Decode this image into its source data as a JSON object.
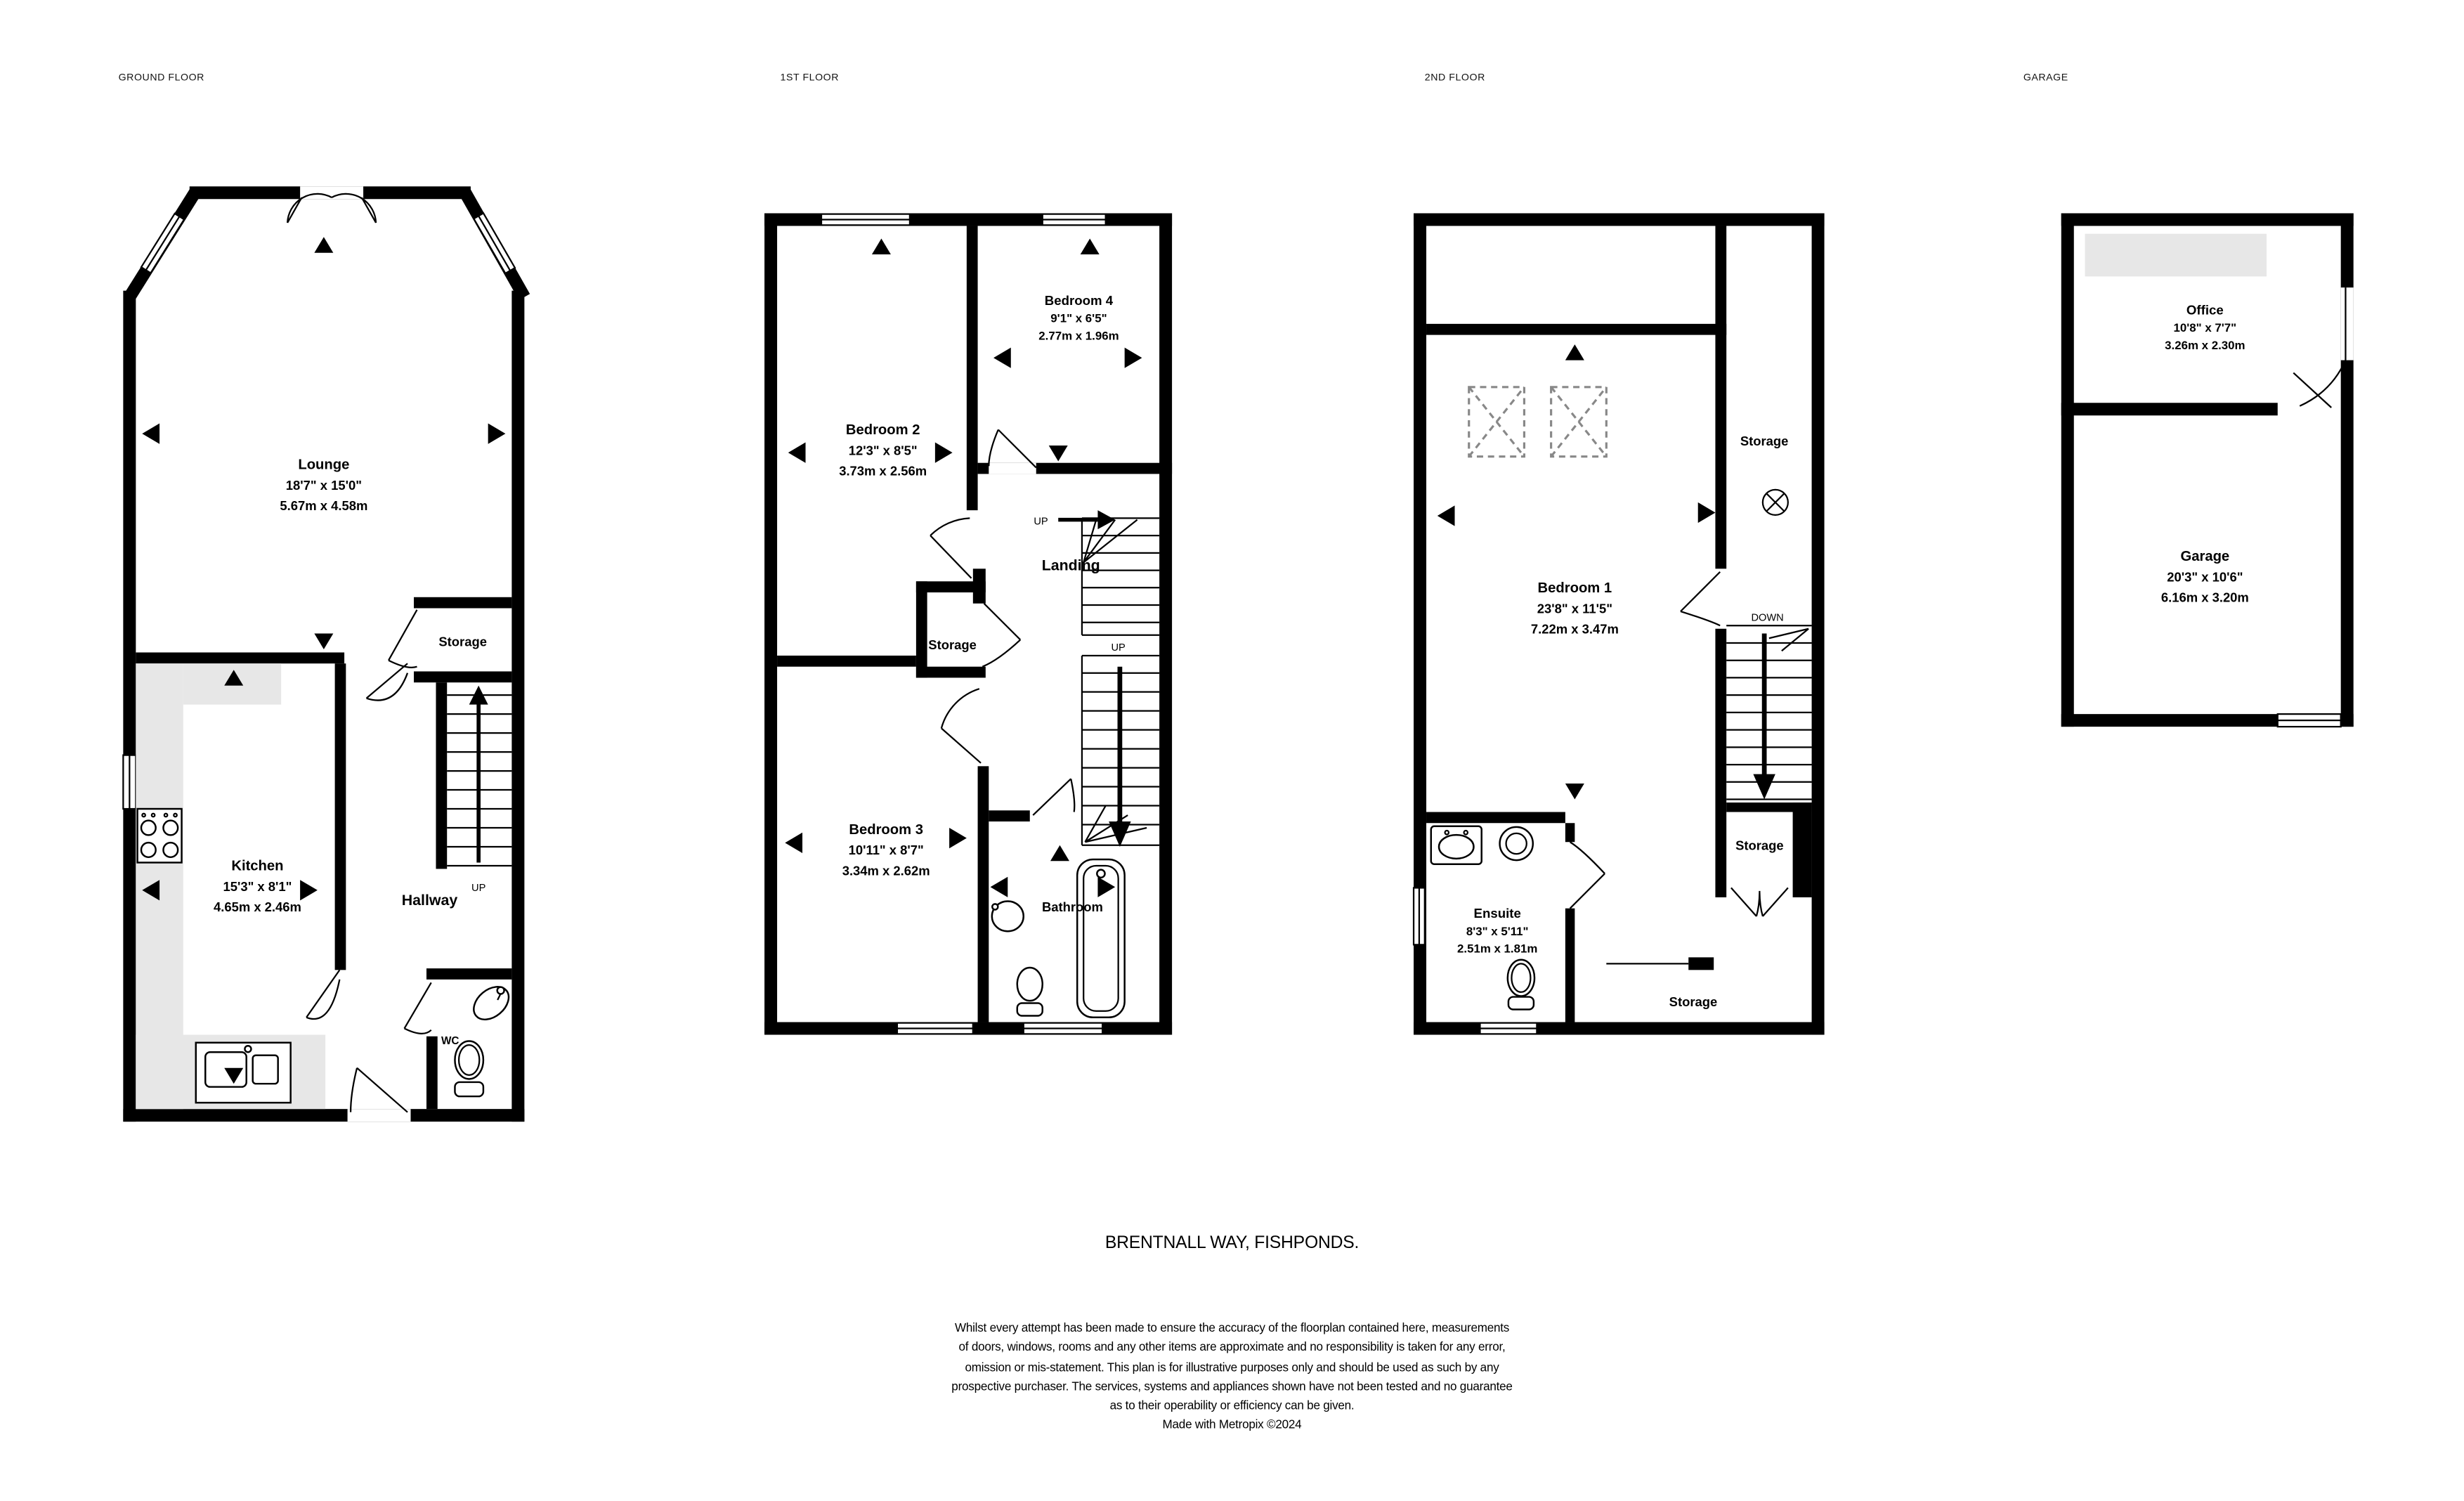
{
  "title": "BRENTNALL WAY, FISHPONDS.",
  "disclaimer": {
    "lines": [
      "Whilst every attempt has been made to ensure the accuracy of the floorplan contained here, measurements",
      "of doors, windows, rooms and any other items are approximate and no responsibility is taken for any error,",
      "omission or mis-statement. This plan is for illustrative purposes only and should be used as such by any",
      "prospective purchaser. The services, systems and appliances shown have not been tested and no guarantee",
      "as to their operability or efficiency can be given."
    ],
    "credit": "Made with Metropix ©2024"
  },
  "floors": {
    "ground": {
      "label": "GROUND FLOOR",
      "lounge": {
        "name": "Lounge",
        "imperial": "18'7\"  x 15'0\"",
        "metric": "5.67m  x 4.58m"
      },
      "kitchen": {
        "name": "Kitchen",
        "imperial": "15'3\"  x 8'1\"",
        "metric": "4.65m  x 2.46m"
      },
      "hallway": "Hallway",
      "storage": "Storage",
      "wc": "WC",
      "up": "UP"
    },
    "first": {
      "label": "1ST FLOOR",
      "bedroom2": {
        "name": "Bedroom 2",
        "imperial": "12'3\"  x 8'5\"",
        "metric": "3.73m  x 2.56m"
      },
      "bedroom4": {
        "name": "Bedroom 4",
        "imperial": "9'1\"  x 6'5\"",
        "metric": "2.77m  x 1.96m"
      },
      "bedroom3": {
        "name": "Bedroom 3",
        "imperial": "10'11\"  x 8'7\"",
        "metric": "3.34m  x 2.62m"
      },
      "landing": "Landing",
      "storage": "Storage",
      "bathroom": "Bathroom",
      "up_top": "UP",
      "up_bottom": "UP"
    },
    "second": {
      "label": "2ND FLOOR",
      "bedroom1": {
        "name": "Bedroom 1",
        "imperial": "23'8\"  x 11'5\"",
        "metric": "7.22m  x 3.47m"
      },
      "ensuite": {
        "name": "Ensuite",
        "imperial": "8'3\"  x 5'11\"",
        "metric": "2.51m  x 1.81m"
      },
      "storage_top": "Storage",
      "storage_mid": "Storage",
      "storage_bottom": "Storage",
      "down": "DOWN"
    },
    "garage": {
      "label": "GARAGE",
      "office": {
        "name": "Office",
        "imperial": "10'8\"  x 7'7\"",
        "metric": "3.26m  x 2.30m"
      },
      "garage": {
        "name": "Garage",
        "imperial": "20'3\"  x 10'6\"",
        "metric": "6.16m  x 3.20m"
      }
    }
  },
  "colors": {
    "wall": "#000000",
    "counter": "#e7e7e7",
    "velux": "#888888"
  }
}
